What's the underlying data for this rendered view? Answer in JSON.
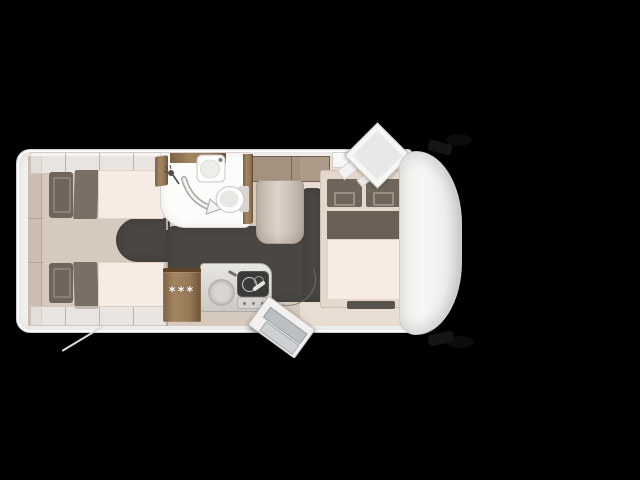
{
  "floorplan": {
    "type": "motorhome-floorplan-top-view",
    "fridge_label": "***"
  },
  "colors": {
    "background": "#000000",
    "shell": "#f3f2f1",
    "shell_border": "#cfccc9",
    "wall_beige": "#d6c9be",
    "wall_band": "#cbbdb2",
    "floor_right": "#e7ddd3",
    "charcoal": "#4a4643",
    "charcoal_edge": "#3e3b38",
    "mattress": "#f7ece3",
    "mattress_edge": "#e2d2c7",
    "cushion": "#6f655b",
    "cushion_light": "#8d8175",
    "wood": "#977a5a",
    "wood_dark": "#6e5233",
    "counter_border": "#aeaba6",
    "fixture": "#fcfcfb",
    "fixture_border": "#c8c6c3",
    "stove": "#3b3a38",
    "glass": "#bcc0c2",
    "hood": "#f3f3f2",
    "mirror": "#151515",
    "star": "#ffffff"
  }
}
